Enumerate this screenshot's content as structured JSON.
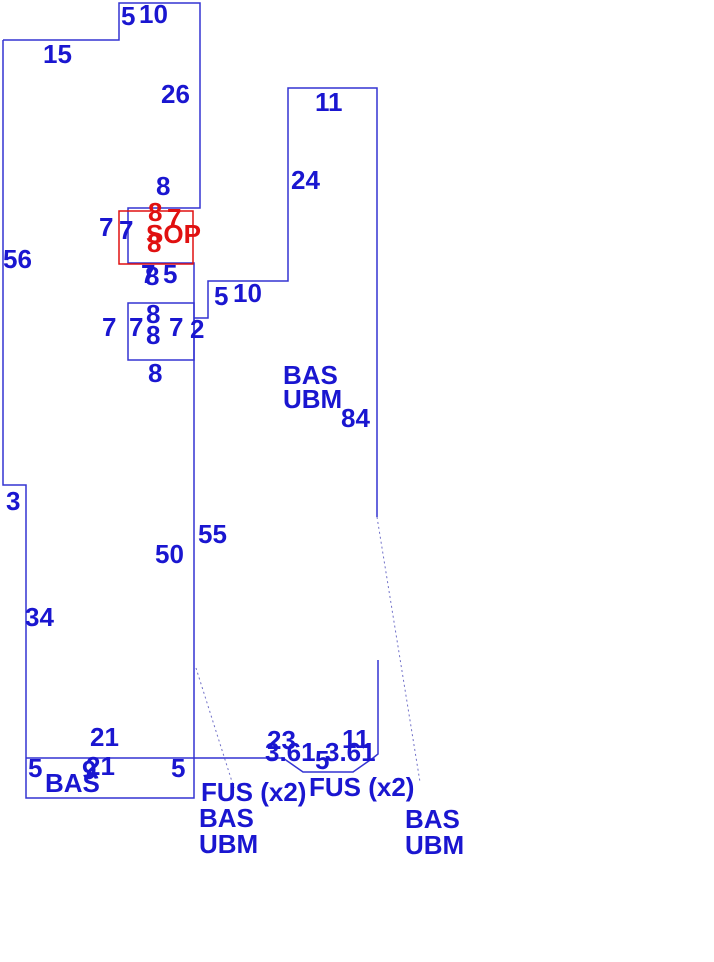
{
  "canvas": {
    "width": 714,
    "height": 962,
    "background": "#ffffff"
  },
  "colors": {
    "outline": "#3434d2",
    "text": "#1a16d0",
    "red": "#e01010",
    "leader": "#7070c8"
  },
  "floorplan": {
    "shapes": [
      {
        "name": "main-building-outline",
        "stroke": "outline",
        "points": "3,40 119,40 119,3 200,3 200,208 128,208 128,263 194,263 194,798 26,798 26,485 3,485 3,40"
      },
      {
        "name": "bottom-room-divider-and-bay",
        "stroke": "outline",
        "points": "26,758 283,758 303,772 353,772 373,758 378,754 378,660"
      },
      {
        "name": "right-building-outline",
        "stroke": "outline",
        "points": "194,318 208,318 208,281 288,281 288,88 377,88 377,517"
      },
      {
        "name": "room-rect",
        "rect": true,
        "x": 128,
        "y": 303,
        "w": 66,
        "h": 57,
        "stroke": "outline"
      },
      {
        "name": "highlight-room-rect",
        "rect": true,
        "x": 119,
        "y": 211,
        "w": 74,
        "h": 53,
        "stroke": "red"
      },
      {
        "name": "leader-line-left",
        "stroke": "leader",
        "dash": true,
        "w": 1,
        "points": "196,668 234,788"
      },
      {
        "name": "leader-line-right",
        "stroke": "leader",
        "dash": true,
        "w": 1,
        "points": "377,517 420,782"
      }
    ]
  },
  "labels": [
    {
      "t": "5",
      "x": 121,
      "y": 3
    },
    {
      "t": "10",
      "x": 139,
      "y": 1
    },
    {
      "t": "15",
      "x": 43,
      "y": 41
    },
    {
      "t": "26",
      "x": 161,
      "y": 81
    },
    {
      "t": "8",
      "x": 156,
      "y": 173
    },
    {
      "t": "56",
      "x": 3,
      "y": 246
    },
    {
      "t": "11",
      "x": 315,
      "y": 89
    },
    {
      "t": "24",
      "x": 291,
      "y": 167
    },
    {
      "t": "7",
      "x": 99,
      "y": 214
    },
    {
      "t": "7",
      "x": 119,
      "y": 217
    },
    {
      "t": "8",
      "x": 148,
      "y": 199,
      "c": "red"
    },
    {
      "t": "7",
      "x": 167,
      "y": 205,
      "c": "red"
    },
    {
      "t": "SOP",
      "x": 146,
      "y": 221,
      "c": "red",
      "n": "room-label-sop"
    },
    {
      "t": "8",
      "x": 147,
      "y": 230,
      "c": "red"
    },
    {
      "t": "7",
      "x": 141,
      "y": 261
    },
    {
      "t": "8",
      "x": 145,
      "y": 263
    },
    {
      "t": "5",
      "x": 163,
      "y": 261
    },
    {
      "t": "5",
      "x": 214,
      "y": 283
    },
    {
      "t": "10",
      "x": 233,
      "y": 280
    },
    {
      "t": "8",
      "x": 146,
      "y": 301
    },
    {
      "t": "8",
      "x": 146,
      "y": 322
    },
    {
      "t": "7",
      "x": 129,
      "y": 314
    },
    {
      "t": "7",
      "x": 169,
      "y": 314
    },
    {
      "t": "7",
      "x": 102,
      "y": 314
    },
    {
      "t": "2",
      "x": 190,
      "y": 316
    },
    {
      "t": "8",
      "x": 148,
      "y": 360
    },
    {
      "t": "BAS",
      "x": 283,
      "y": 362,
      "n": "room-label-bas"
    },
    {
      "t": "UBM",
      "x": 283,
      "y": 386,
      "n": "room-label-ubm"
    },
    {
      "t": "84",
      "x": 341,
      "y": 405
    },
    {
      "t": "55",
      "x": 198,
      "y": 521
    },
    {
      "t": "50",
      "x": 155,
      "y": 541
    },
    {
      "t": "3",
      "x": 6,
      "y": 488
    },
    {
      "t": "34",
      "x": 25,
      "y": 604
    },
    {
      "t": "21",
      "x": 90,
      "y": 724
    },
    {
      "t": "5",
      "x": 28,
      "y": 755
    },
    {
      "t": "9",
      "x": 82,
      "y": 757
    },
    {
      "t": "21",
      "x": 86,
      "y": 753
    },
    {
      "t": "5",
      "x": 171,
      "y": 755
    },
    {
      "t": "BAS",
      "x": 45,
      "y": 770,
      "n": "room-label-bas"
    },
    {
      "t": "23",
      "x": 267,
      "y": 727
    },
    {
      "t": "11",
      "x": 342,
      "y": 726
    },
    {
      "t": "3.61",
      "x": 265,
      "y": 739
    },
    {
      "t": "5",
      "x": 315,
      "y": 747
    },
    {
      "t": "3.61",
      "x": 325,
      "y": 739
    },
    {
      "t": "FUS (x2)",
      "x": 201,
      "y": 779,
      "n": "room-label-fus"
    },
    {
      "t": "BAS",
      "x": 199,
      "y": 805,
      "n": "room-label-bas"
    },
    {
      "t": "UBM",
      "x": 199,
      "y": 831,
      "n": "room-label-ubm"
    },
    {
      "t": "FUS (x2)",
      "x": 309,
      "y": 774,
      "n": "room-label-fus"
    },
    {
      "t": "BAS",
      "x": 405,
      "y": 806,
      "n": "room-label-bas"
    },
    {
      "t": "UBM",
      "x": 405,
      "y": 832,
      "n": "room-label-ubm"
    }
  ]
}
